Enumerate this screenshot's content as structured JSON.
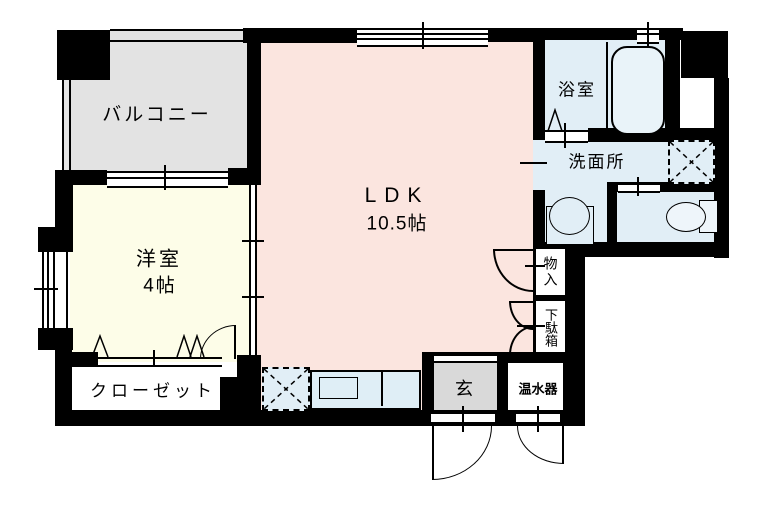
{
  "floorplan": {
    "kind": "japanese-apartment-floor-plan",
    "colors": {
      "wall": "#000000",
      "balcony_fill": "#e3e3e3",
      "ldk_fill": "#fbe5df",
      "western_room_fill": "#fdfde8",
      "wet_area_fill": "#e1eef6",
      "entrance_fill": "#d9d9d9",
      "background": "#ffffff"
    },
    "rooms": {
      "balcony": {
        "label": "バルコニー"
      },
      "ldk": {
        "label": "LDK",
        "size": "10.5帖"
      },
      "western_room": {
        "label": "洋室",
        "size": "4帖"
      },
      "bathroom": {
        "label": "浴室"
      },
      "washroom": {
        "label": "洗面所"
      },
      "closet": {
        "label": "クローゼット"
      },
      "entrance": {
        "label": "玄"
      },
      "water_heater": {
        "label": "温水器"
      },
      "storage": {
        "label": "物入"
      },
      "shoe_cabinet": {
        "label": "下駄箱"
      }
    }
  }
}
